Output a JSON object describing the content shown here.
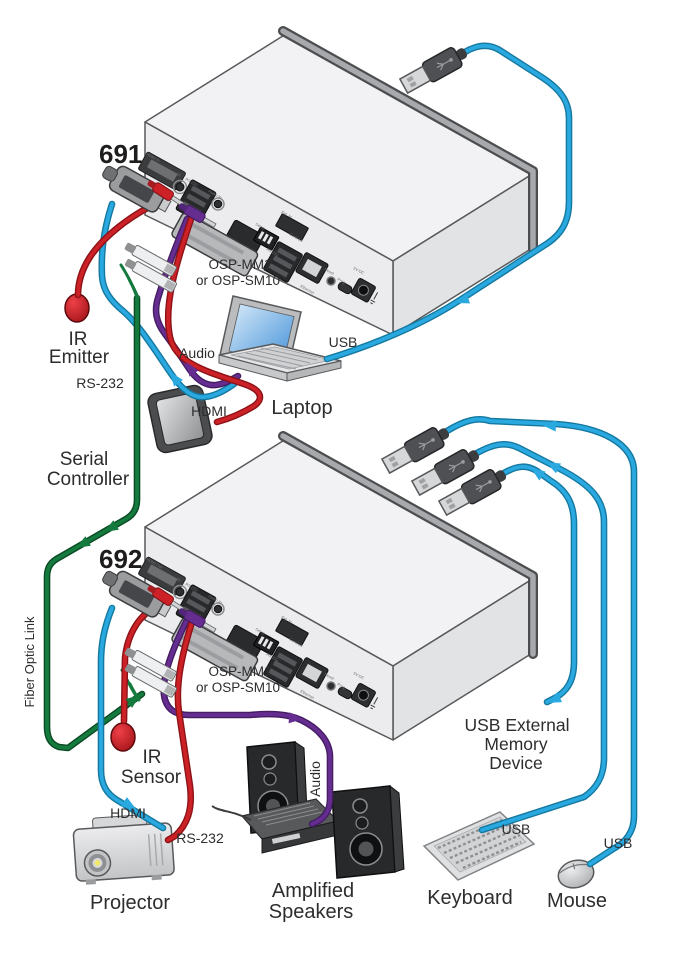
{
  "transmitter": {
    "model": "691",
    "sfp_module_line1": "OSP-MM1",
    "sfp_module_line2": "or OSP-SM10",
    "ports": {
      "hdmi": "HDMI In",
      "ir": "IR",
      "rs232_av": "RS-232",
      "audio": "Audio In",
      "ext": "Ext. In",
      "setup": "Setup",
      "controls": "Controls",
      "rs232_ctrl": "RS-232",
      "ethernet": "Ethernet",
      "reset": "Reset",
      "prog": "Prog.",
      "power": "5V DC"
    }
  },
  "receiver": {
    "model": "692",
    "sfp_module_line1": "OSP-MM1",
    "sfp_module_line2": "or OSP-SM10",
    "ports": {
      "hdmi": "HDMI Out",
      "ir": "IR",
      "rs232_av": "RS-232",
      "audio": "Audio In",
      "ext": "Ext. In",
      "setup": "Setup",
      "controls": "Controls",
      "rs232_ctrl": "RS-232",
      "ethernet": "Ethernet",
      "reset": "Reset",
      "prog": "Prog.",
      "power": "5V DC"
    }
  },
  "connections": {
    "usb_laptop": "USB",
    "audio_laptop": "Audio",
    "hdmi_laptop": "HDMI",
    "rs232_controller": "RS-232",
    "fiber_link": "Fiber Optic Link",
    "audio_speakers": "Audio",
    "hdmi_projector": "HDMI",
    "rs232_projector": "RS-232",
    "usb_keyboard": "USB",
    "usb_mouse": "USB"
  },
  "peripherals": {
    "ir_emitter": {
      "line1": "IR",
      "line2": "Emitter"
    },
    "serial_controller": {
      "line1": "Serial",
      "line2": "Controller"
    },
    "laptop": {
      "label": "Laptop"
    },
    "ir_sensor": {
      "line1": "IR",
      "line2": "Sensor"
    },
    "projector": {
      "label": "Projector"
    },
    "amplified_speakers": {
      "line1": "Amplified",
      "line2": "Speakers"
    },
    "usb_memory": {
      "line1": "USB External",
      "line2": "Memory",
      "line3": "Device"
    },
    "keyboard": {
      "label": "Keyboard"
    },
    "mouse": {
      "label": "Mouse"
    }
  },
  "colors": {
    "usb_cable": "#29a9e0",
    "video_cable": "#29a9e0",
    "ir_cable": "#cc2227",
    "serial_cable": "#cc2227",
    "audio_cable": "#662d91",
    "fiber_cable": "#157a3d",
    "chassis": "#f0f0f2",
    "outline": "#58595b"
  }
}
